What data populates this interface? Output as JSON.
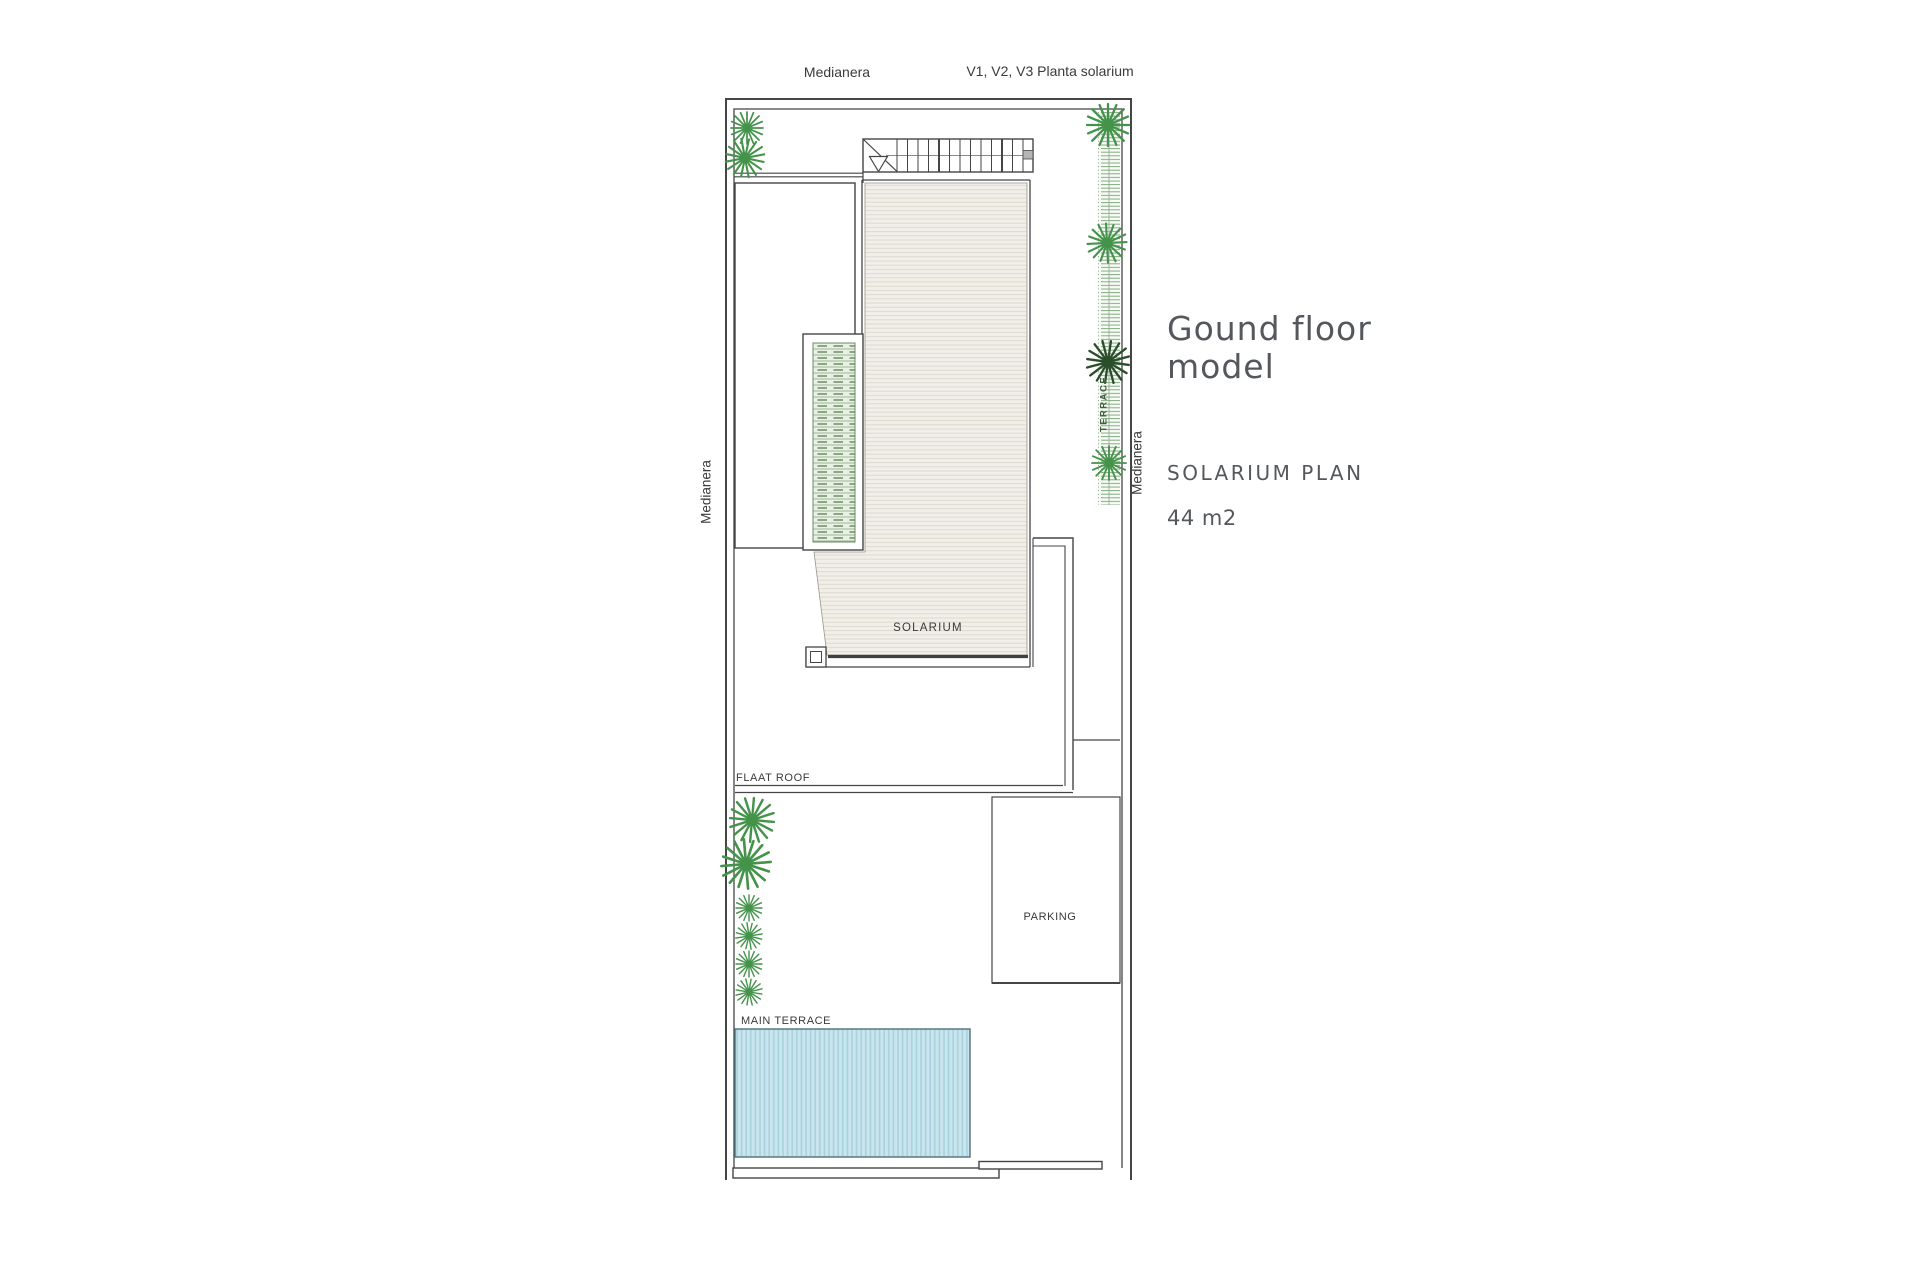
{
  "plan": {
    "boundary_label_top": "Medianera",
    "boundary_label_left": "Medianera",
    "boundary_label_right": "Medianera",
    "drawing_note": "V1, V2, V3 Planta solarium",
    "terrace_label": "TERRACE",
    "solarium_label": "SOLARIUM",
    "flat_roof_label": "FLAAT ROOF",
    "parking_label": "PARKING",
    "main_terrace_label": "MAIN TERRACE"
  },
  "info_panel": {
    "title": "Gound floor model",
    "plan_name": "SOLARIUM PLAN",
    "area": "44 m2"
  },
  "colors": {
    "line": "#454545",
    "label_text": "#3a3a3a",
    "info_text": "#54575b",
    "plant_green": "#44934a",
    "plant_dark": "#2a4d2a",
    "pool_fill": "#c9e5ed",
    "pool_stripe": "#a9d2dd",
    "deck_fill": "#f1efe9",
    "deck_line": "#ded9ce",
    "planter_fill": "#e9f1e4",
    "planter_green": "#5d7b55",
    "hedge_green": "#7aa377"
  }
}
